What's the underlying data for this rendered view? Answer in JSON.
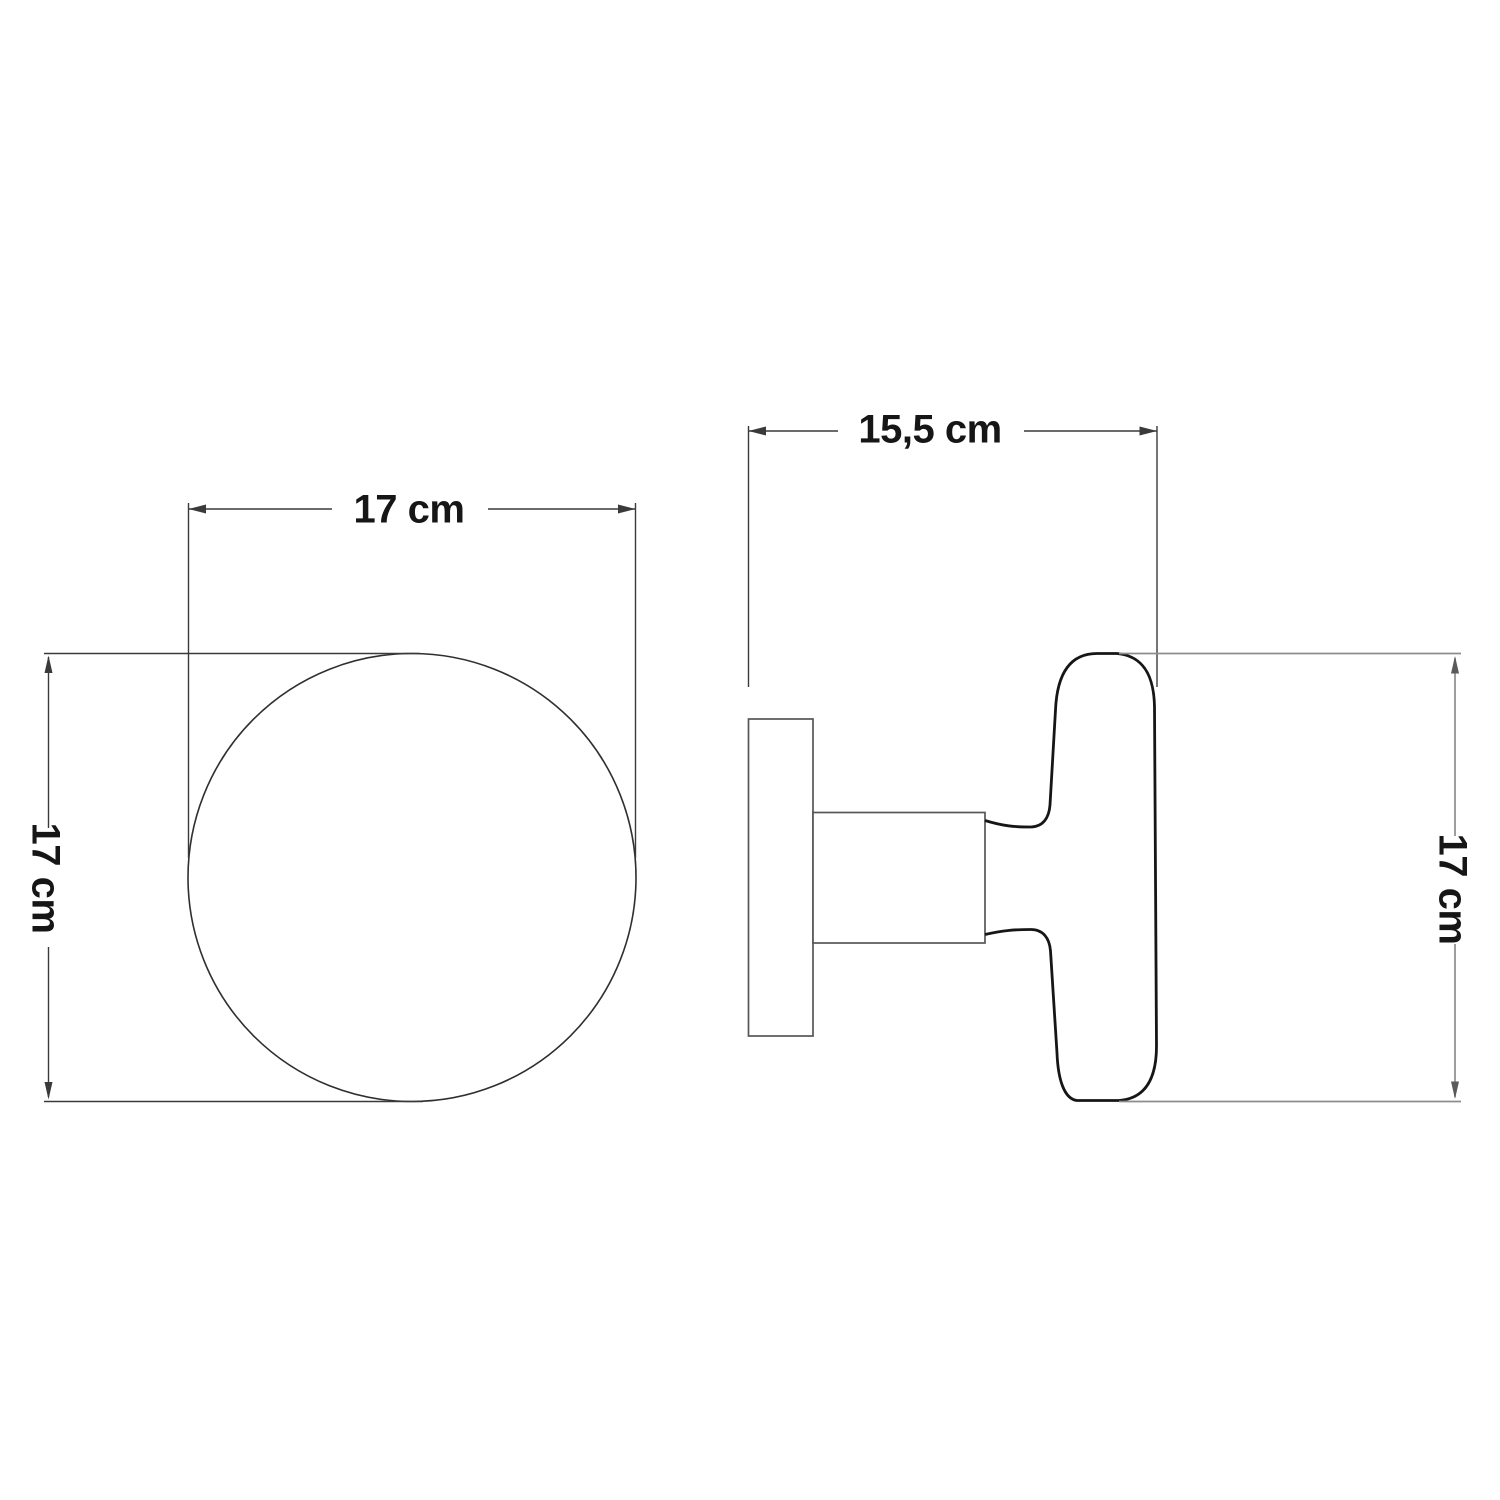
{
  "drawing": {
    "description": "Technical dimension drawing of a round wall knob, front view and side profile view",
    "views": {
      "front": {
        "name": "front-view-circle",
        "label_width": "17 cm",
        "label_height": "17 cm"
      },
      "side": {
        "name": "side-profile-view",
        "label_width": "15,5 cm",
        "label_height": "17 cm"
      }
    },
    "colors": {
      "background": "#ffffff",
      "dimension_dark": "#3a3a3a",
      "dimension_gray": "#8d8d8d",
      "object_outline_bold": "#161616",
      "object_outline_thin": "#565656",
      "circle_outline": "#2f2f2f",
      "text": "#161616"
    }
  }
}
